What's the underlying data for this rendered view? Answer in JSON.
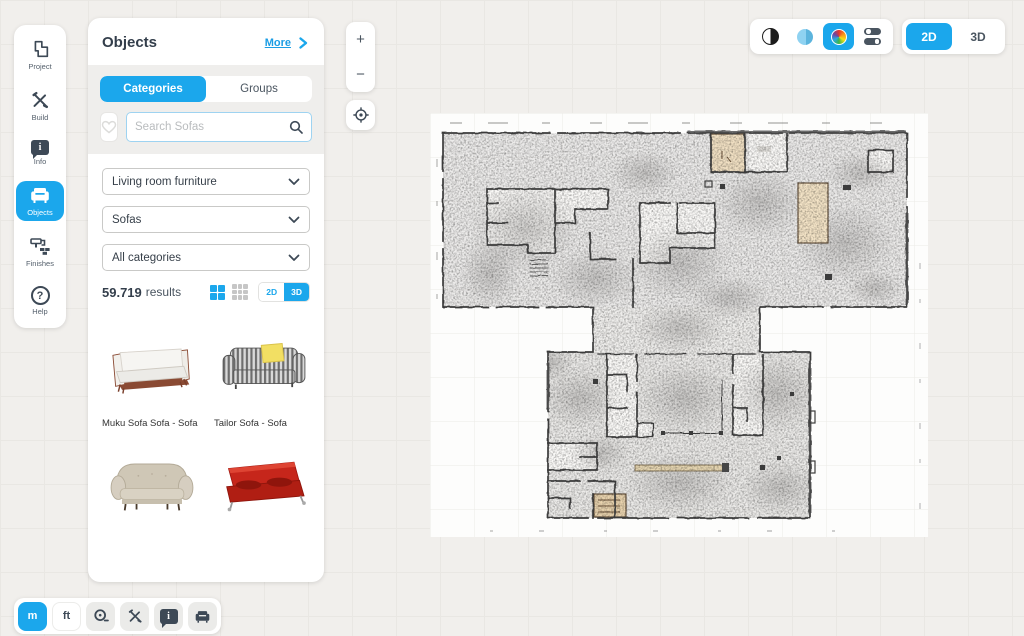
{
  "sidebar": {
    "items": [
      {
        "label": "Project",
        "icon": "floorplan-icon",
        "active": false
      },
      {
        "label": "Build",
        "icon": "build-tools-icon",
        "active": false
      },
      {
        "label": "Info",
        "icon": "info-bubble-icon",
        "active": false
      },
      {
        "label": "Objects",
        "icon": "sofa-icon",
        "active": true
      },
      {
        "label": "Finishes",
        "icon": "paint-roller-icon",
        "active": false
      },
      {
        "label": "Help",
        "icon": "help-icon",
        "active": false
      }
    ]
  },
  "objects_panel": {
    "title": "Objects",
    "more_label": "More",
    "tabs": {
      "categories": "Categories",
      "groups": "Groups",
      "active": "Categories"
    },
    "search_placeholder": "Search Sofas",
    "filters": [
      "Living room furniture",
      "Sofas",
      "All categories"
    ],
    "results_count": "59.719",
    "results_label": "results",
    "mini_view_toggle": {
      "options": [
        "2D",
        "3D"
      ],
      "active": "3D"
    },
    "products": [
      {
        "name": "Muku Sofa Sofa - Sofa",
        "appearance": "white sofa with wooden frame"
      },
      {
        "name": "Tailor Sofa - Sofa",
        "appearance": "grey striped sofa with yellow cushion"
      },
      {
        "name": "",
        "appearance": "beige classic sofa"
      },
      {
        "name": "",
        "appearance": "red futon sofa"
      }
    ]
  },
  "canvas_controls": {
    "zoom_in": "+",
    "zoom_out": "−",
    "center": "locate-target"
  },
  "header_controls": {
    "render_modes": [
      "contrast-icon",
      "monochrome-icon",
      "color-wheel-icon",
      "toggles-icon"
    ],
    "active_render_mode": "color-wheel-icon",
    "view_switch": {
      "options": [
        "2D",
        "3D"
      ],
      "active": "2D"
    }
  },
  "bottom_toolbar": {
    "unit_m": "m",
    "unit_ft": "ft",
    "active_unit": "m",
    "tools": [
      "tape-measure-icon",
      "build-tools-icon",
      "info-bubble-icon",
      "sofa-icon"
    ]
  },
  "glyphs": {
    "help": "?",
    "info": "i"
  },
  "colors": {
    "accent_blue": "#1ba7ec",
    "icon_slate": "#3d4956",
    "canvas_bg": "#f1efec",
    "plan_tan": "#f1e0c3",
    "sofa_red": "#c6261b",
    "pillow_yellow": "#f2df63"
  }
}
